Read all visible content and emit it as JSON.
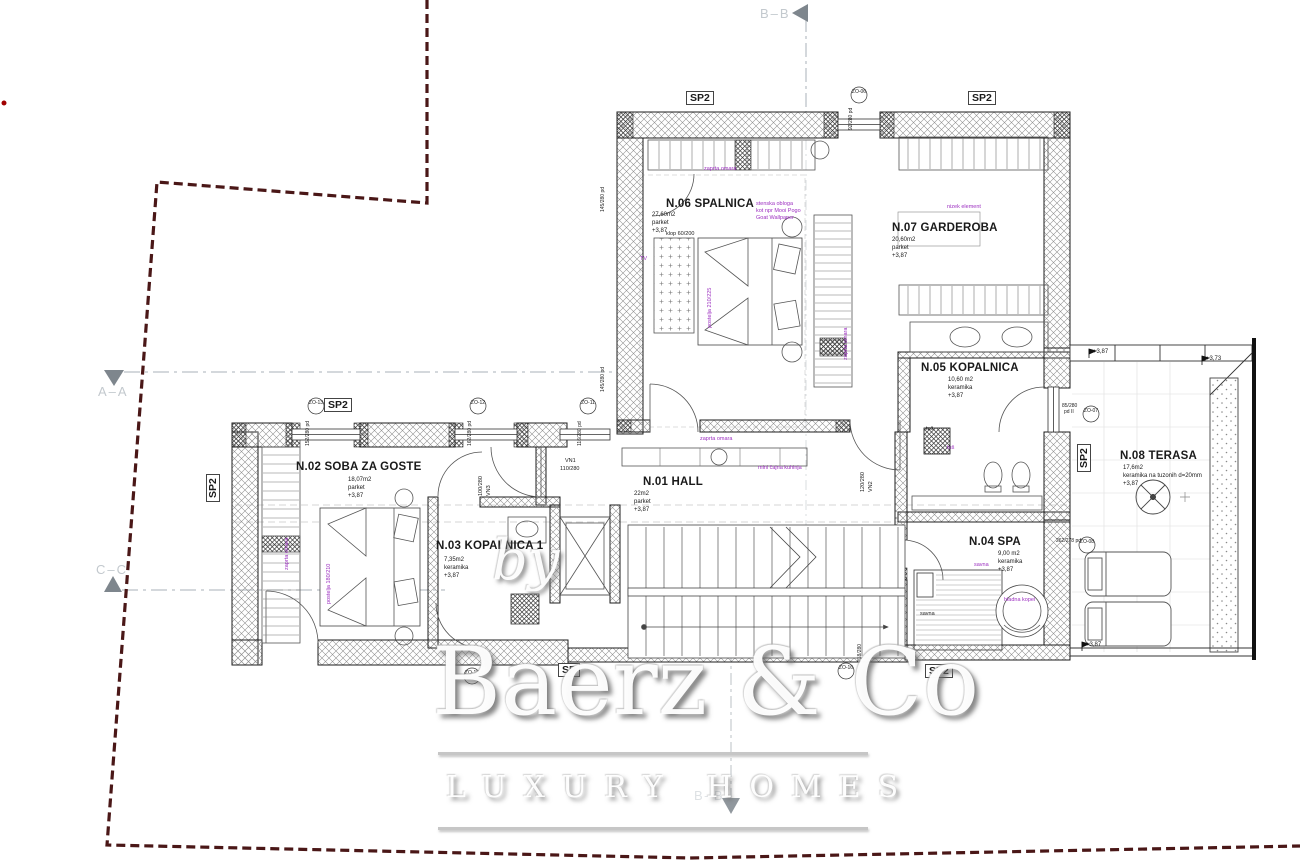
{
  "colors": {
    "purple": "#9c2fc0",
    "boundary": "#4a1717",
    "section_marker": "#aab2b8"
  },
  "watermark": {
    "by": "by",
    "brand": "Baerz & Co",
    "tagline": "LUXURY HOMES"
  },
  "sections": {
    "top_bb": "B–B",
    "bottom_bb": "B–B",
    "left_aa": "A–A",
    "left_cc": "C–C"
  },
  "rooms": {
    "n06": {
      "name": "N.06 SPALNICA",
      "area": "27,60m2",
      "floor": "parket",
      "level": "+3,87"
    },
    "n07": {
      "name": "N.07 GARDEROBA",
      "area": "20,60m2",
      "floor": "parket",
      "level": "+3,87"
    },
    "n05": {
      "name": "N.05 KOPALNICA",
      "area": "10,60 m2",
      "floor": "keramika",
      "level": "+3,87"
    },
    "n01": {
      "name": "N.01 HALL",
      "area": "22m2",
      "floor": "parket",
      "level": "+3,87"
    },
    "n02": {
      "name": "N.02 SOBA ZA GOSTE",
      "area": "18,07m2",
      "floor": "parket",
      "level": "+3,87"
    },
    "n03": {
      "name": "N.03 KOPALNICA 1",
      "area": "7,35m2",
      "floor": "keramika",
      "level": "+3,87"
    },
    "n04": {
      "name": "N.04 SPA",
      "area": "9,00 m2",
      "floor": "keramika",
      "level": "+3,87"
    },
    "n08": {
      "name": "N.08 TERASA",
      "area": "17,6m2",
      "floor": "keramika na tuzonih d=20mm",
      "level": "+3,87"
    }
  },
  "annotations": {
    "closet_top": "zaprta omara",
    "closet_right": "zaprta omara",
    "closet_bottom": "zaprta omara",
    "closet_n02": "zaprta omara",
    "bed_n06": "postelja 210/225",
    "bed_n02": "postelja 180/210",
    "bench": "klop 60/200",
    "tv": "TV",
    "cladding1": "stenska obloga",
    "cladding2": "kot npr Mooi Pogo",
    "cladding3": "Goat Wallpaper",
    "low_unit": "nizek element",
    "mini_kitchen": "mini čajna kuhinja",
    "sauna_label": "savna",
    "sauna_label2": "savna",
    "cold_bath": "hladna kopel",
    "shower1": "tuš",
    "shower2": "tuš"
  },
  "panels": {
    "sp2": "SP2",
    "sp": "SP"
  },
  "doors": [
    {
      "code": "VN1",
      "dim": "110/280"
    },
    {
      "code": "VN2",
      "dim": "120/280"
    },
    {
      "code": "VN3",
      "dim": "100/280"
    }
  ],
  "openings": [
    {
      "code": "ZO-13",
      "dim": "152/280 pd"
    },
    {
      "code": "ZO-12",
      "dim": "162/280 pd"
    },
    {
      "code": "ZO-11",
      "dim": "116/280 pd"
    },
    {
      "code": "ZO-06",
      "dim": "92/280 pd"
    },
    {
      "code": "ZO-07",
      "dim": "85/280",
      "dim2": "pd II"
    },
    {
      "code": "ZO-08",
      "dim": "262/278 pd"
    },
    {
      "code": "ZO-15",
      "dim": "190/280"
    },
    {
      "code": "ZO-16",
      "dim": "218/280"
    }
  ],
  "wall_dims": {
    "d1": "145/280 pd",
    "d2": "145/280 pd"
  },
  "elevations": {
    "terrace_a": "+3,87",
    "terrace_b": "+3,73",
    "terrace_c": "+3,87"
  }
}
